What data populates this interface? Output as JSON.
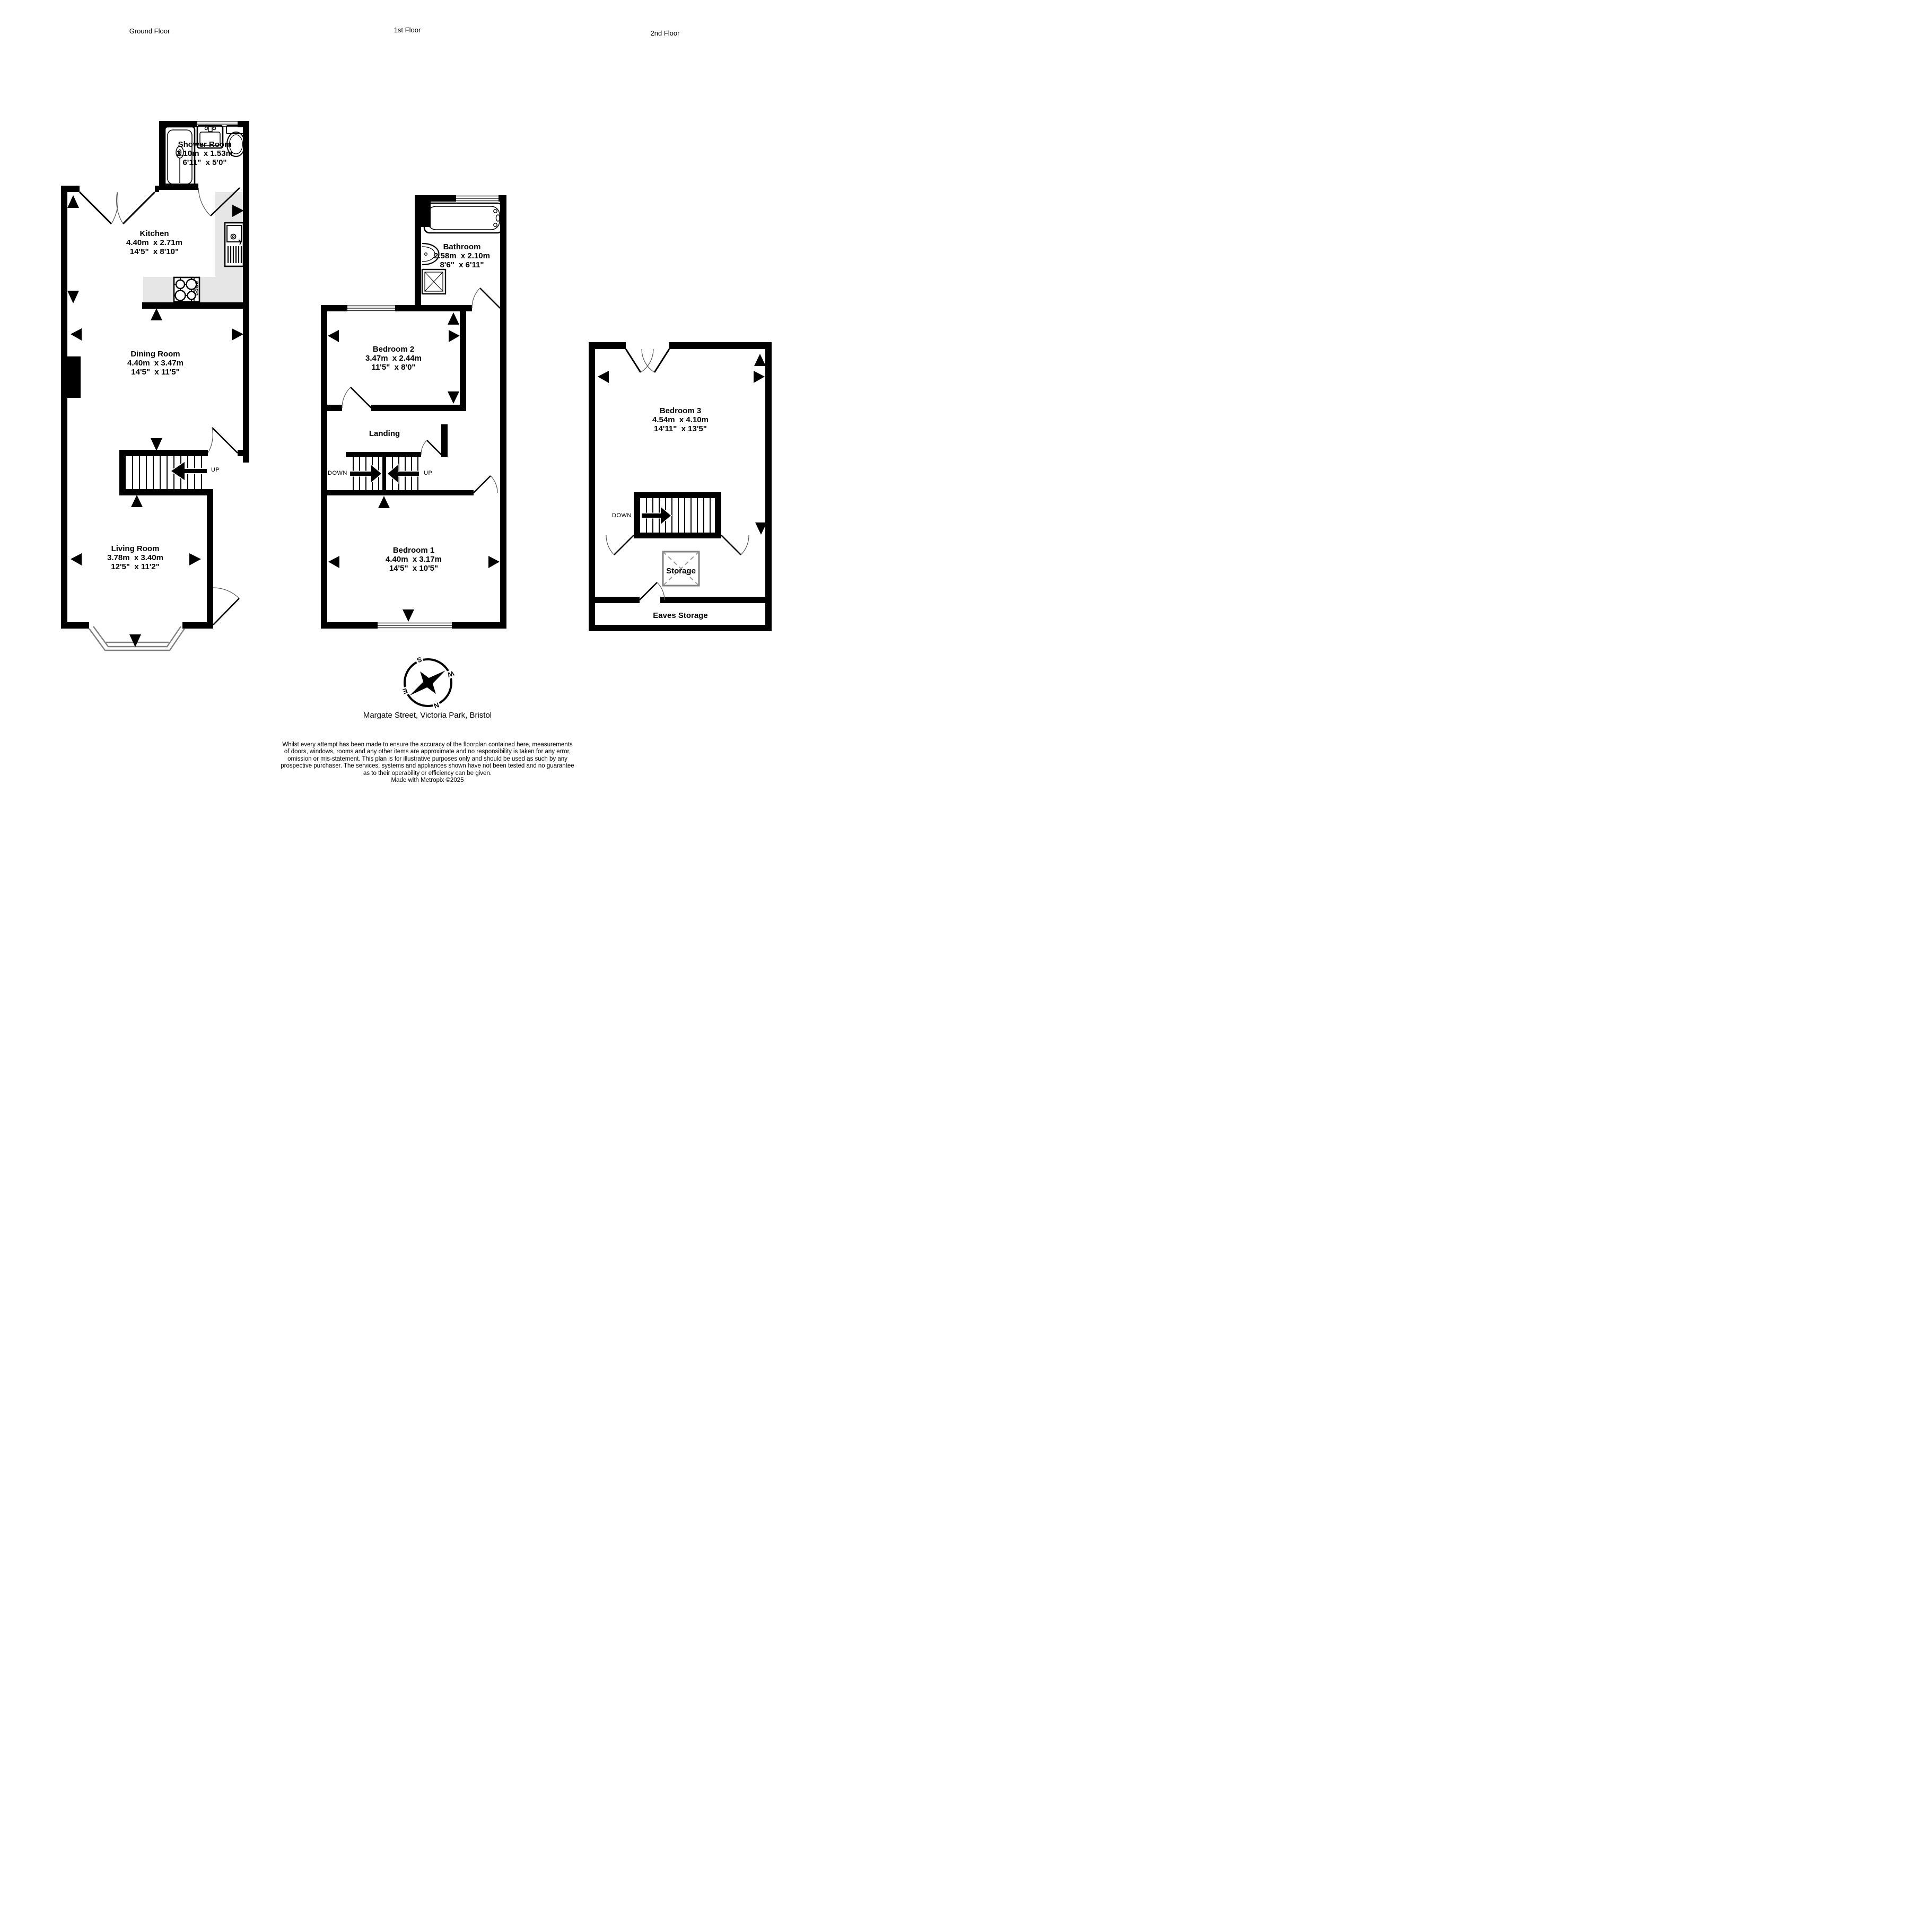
{
  "floors": {
    "ground": "Ground Floor",
    "first": "1st Floor",
    "second": "2nd Floor"
  },
  "rooms": {
    "shower_room": {
      "name": "Shower Room",
      "metric": "2.10m  x 1.53m",
      "imperial": "6'11\"  x 5'0\""
    },
    "kitchen": {
      "name": "Kitchen",
      "metric": "4.40m  x 2.71m",
      "imperial": "14'5\"  x 8'10\""
    },
    "dining_room": {
      "name": "Dining Room",
      "metric": "4.40m  x 3.47m",
      "imperial": "14'5\"  x 11'5\""
    },
    "living_room": {
      "name": "Living Room",
      "metric": "3.78m  x 3.40m",
      "imperial": "12'5\"  x 11'2\""
    },
    "bathroom": {
      "name": "Bathroom",
      "metric": "2.58m  x 2.10m",
      "imperial": "8'6\"  x 6'11\""
    },
    "bedroom2": {
      "name": "Bedroom 2",
      "metric": "3.47m  x 2.44m",
      "imperial": "11'5\"  x 8'0\""
    },
    "bedroom1": {
      "name": "Bedroom 1",
      "metric": "4.40m  x 3.17m",
      "imperial": "14'5\"  x 10'5\""
    },
    "bedroom3": {
      "name": "Bedroom 3",
      "metric": "4.54m  x 4.10m",
      "imperial": "14'11\"  x 13'5\""
    }
  },
  "areas": {
    "landing": "Landing",
    "storage": "Storage",
    "eaves_storage": "Eaves Storage"
  },
  "stairs": {
    "up_label": "UP",
    "down_label": "DOWN"
  },
  "compass": {
    "n": "N",
    "s": "S",
    "e": "E",
    "w": "W"
  },
  "address": "Margate Street, Victoria Park, Bristol",
  "disclaimer": {
    "lines": [
      "Whilst every attempt has been made to ensure the accuracy of the floorplan contained here, measurements",
      "of doors, windows, rooms and any other items are approximate and no responsibility is taken for any error,",
      "omission or mis-statement. This plan is for illustrative purposes only and should be used as such by any",
      "prospective purchaser. The services, systems and appliances shown have not been tested and no guarantee",
      "as to their operability or efficiency can be given."
    ],
    "credit": "Made with Metropix ©2025"
  },
  "colors": {
    "wall": "#000000",
    "counter": "#e6e6e6",
    "window_line": "#333333",
    "bay_line": "#808080",
    "storage_line": "#808080"
  }
}
